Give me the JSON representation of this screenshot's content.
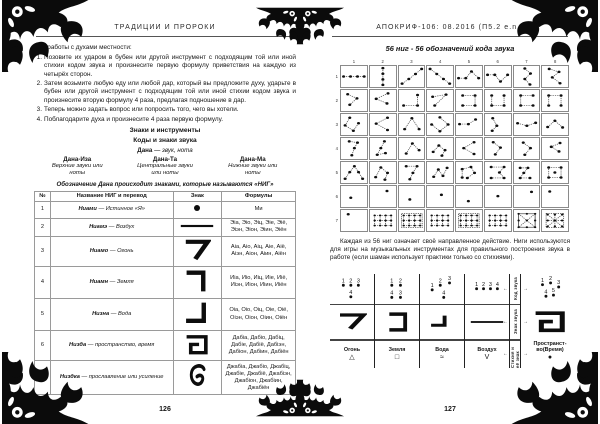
{
  "colors": {
    "ink": "#161616",
    "ornament": "#0b0b0b",
    "grid_border": "#8a8a8a"
  },
  "left_page": {
    "header": "ТРАДИЦИИ И ПРОРОКИ",
    "intro": "Для работы с духами местности:",
    "list": [
      "Позовите их ударом в бубен или другой инструмент с подходящим той или иной стихии кодом звука и произнесите первую формулу приветствия на каждую из четырёх сторон.",
      "Затем возьмите любую еду или любой дар, который вы предложите духу, ударьте в бубен или другой инструмент с подходящим той или иной стихии кодом звука и произнесите вторую формулу 4 раза, предлагая подношение в дар.",
      "Теперь можно задать вопрос или попросить того, чего вы хотели.",
      "Поблагодарите духа и произнесите 4 раза первую формулу."
    ],
    "section_title": "Знаки и инструменты",
    "subsection_title": "Коды и знаки звука",
    "dana_term": "Дана",
    "dana_def": "— звук, нота",
    "dana_columns": [
      {
        "name": "Дана-Иза",
        "desc": "Верхние звуки или ноты"
      },
      {
        "name": "Дана-Та",
        "desc": "Центральные звуки или ноты"
      },
      {
        "name": "Дана-Ма",
        "desc": "Нижние звуки или ноты"
      }
    ],
    "nig_line": "Обозначение Дана происходит знаками, которые называются «НИГ»",
    "table": {
      "headers": [
        "№",
        "Название НИГ и перевод",
        "Знак",
        "Формулы"
      ],
      "rows": [
        {
          "num": "1",
          "name": "Ниами",
          "meaning": "Истинное «Я»",
          "glyph": "dot-glyph",
          "formulas": "Ми"
        },
        {
          "num": "2",
          "name": "Ниамэ",
          "meaning": "Воздух",
          "glyph": "bar-glyph",
          "formulas": "Эiа, Эiо, Эiц, Эiе, Эiё, Эiэн, Эiон, Эiин, Эiён"
        },
        {
          "num": "3",
          "name": "Ниамо",
          "meaning": "Огонь",
          "glyph": "seven-glyph",
          "formulas": "Аiа, Аiо, Аiц, Аiе, Аiё, Аiэн, Аiон, Аiин, Аiён"
        },
        {
          "num": "4",
          "name": "Ниамн",
          "meaning": "Земля",
          "glyph": "angle-right-glyph",
          "formulas": "Иiа, Иiо, Иiц, Иiе, Иiё, Иiэн, Иiон, Иiин, Иiён"
        },
        {
          "num": "5",
          "name": "Низна",
          "meaning": "Вода",
          "glyph": "angle-left-glyph",
          "formulas": "Оiа, Оiо, Оiц, Оiе, Оiё, Оiэн, Оiон, Оiин, Оiён"
        },
        {
          "num": "6",
          "name": "Низда",
          "meaning": "пространство, время",
          "glyph": "spiral-glyph",
          "formulas": "Дабiа, Дабiо, Дабiц, Дабiе, Дабiё, Дабiэн, Дабiон, Дабiин, Дабiён"
        },
        {
          "num": "7",
          "name": "Низдка",
          "meaning": "прославление или усиление",
          "glyph": "hook-glyph",
          "formulas": "Джабiа, Джабiо, Джабiц, Джабiе, Джабiё, Джабiэн, Джабiон, Джабiин, Джабiён"
        }
      ]
    },
    "page_number": "126"
  },
  "right_page": {
    "header": "АПОКРИФ-106: 08.2016 (П5.2 e.n.)",
    "figure": {
      "title": "56 ниг - 56 обозначений кода звука",
      "col_headers": [
        "1",
        "2",
        "3",
        "4",
        "5",
        "6",
        "7",
        "8"
      ],
      "row_headers": [
        "1",
        "2",
        "3",
        "4",
        "5",
        "6",
        "7"
      ],
      "cells": [
        {
          "p": [
            [
              10,
              50
            ],
            [
              37,
              50
            ],
            [
              64,
              50
            ],
            [
              90,
              50
            ]
          ]
        },
        {
          "p": [
            [
              50,
              10
            ],
            [
              50,
              37
            ],
            [
              50,
              64
            ],
            [
              50,
              90
            ]
          ]
        },
        {
          "p": [
            [
              12,
              84
            ],
            [
              38,
              62
            ],
            [
              64,
              38
            ],
            [
              88,
              14
            ]
          ]
        },
        {
          "p": [
            [
              12,
              14
            ],
            [
              38,
              38
            ],
            [
              64,
              62
            ],
            [
              88,
              84
            ]
          ]
        },
        {
          "p": [
            [
              10,
              58
            ],
            [
              38,
              58
            ],
            [
              60,
              26
            ],
            [
              88,
              58
            ]
          ]
        },
        {
          "p": [
            [
              10,
              42
            ],
            [
              38,
              42
            ],
            [
              60,
              74
            ],
            [
              88,
              42
            ]
          ]
        },
        {
          "p": [
            [
              42,
              12
            ],
            [
              64,
              36
            ],
            [
              42,
              62
            ],
            [
              62,
              88
            ]
          ]
        },
        {
          "p": [
            [
              28,
              14
            ],
            [
              66,
              28
            ],
            [
              40,
              54
            ],
            [
              70,
              82
            ]
          ]
        },
        {
          "p": [
            [
              26,
              20
            ],
            [
              62,
              40
            ],
            [
              34,
              70
            ]
          ]
        },
        {
          "p": [
            [
              70,
              16
            ],
            [
              24,
              42
            ],
            [
              66,
              64
            ]
          ]
        },
        {
          "p": [
            [
              18,
              74
            ],
            [
              72,
              74
            ],
            [
              72,
              24
            ]
          ]
        },
        {
          "p": [
            [
              22,
              32
            ],
            [
              74,
              22
            ],
            [
              30,
              74
            ]
          ]
        },
        {
          "p": [
            [
              26,
              26
            ],
            [
              74,
              26
            ],
            [
              74,
              74
            ],
            [
              26,
              74
            ]
          ]
        },
        {
          "p": [
            [
              26,
              26
            ],
            [
              26,
              74
            ],
            [
              74,
              74
            ],
            [
              74,
              26
            ]
          ]
        },
        {
          "p": [
            [
              74,
              26
            ],
            [
              26,
              26
            ],
            [
              26,
              74
            ],
            [
              74,
              74
            ]
          ]
        },
        {
          "p": [
            [
              26,
              74
            ],
            [
              26,
              26
            ],
            [
              74,
              26
            ],
            [
              74,
              74
            ]
          ]
        },
        {
          "p": [
            [
              34,
              18
            ],
            [
              16,
              54
            ],
            [
              48,
              80
            ],
            [
              68,
              44
            ]
          ]
        },
        {
          "p": [
            [
              68,
              18
            ],
            [
              24,
              46
            ],
            [
              68,
              76
            ]
          ]
        },
        {
          "p": [
            [
              22,
              72
            ],
            [
              50,
              20
            ],
            [
              78,
              72
            ]
          ]
        },
        {
          "p": [
            [
              50,
              16
            ],
            [
              82,
              50
            ],
            [
              50,
              82
            ],
            [
              18,
              50
            ]
          ]
        },
        {
          "p": [
            [
              14,
              48
            ],
            [
              48,
              48
            ],
            [
              76,
              26
            ]
          ]
        },
        {
          "p": [
            [
              30,
              20
            ],
            [
              46,
              56
            ],
            [
              28,
              80
            ]
          ]
        },
        {
          "p": [
            [
              14,
              44
            ],
            [
              50,
              56
            ],
            [
              84,
              42
            ]
          ]
        },
        {
          "p": [
            [
              22,
              62
            ],
            [
              50,
              32
            ],
            [
              80,
              64
            ]
          ]
        },
        {
          "p": [
            [
              32,
              16
            ],
            [
              64,
              22
            ],
            [
              52,
              48
            ],
            [
              42,
              82
            ]
          ]
        },
        {
          "p": [
            [
              56,
              16
            ],
            [
              42,
              48
            ],
            [
              28,
              80
            ],
            [
              60,
              72
            ]
          ]
        },
        {
          "p": [
            [
              28,
              74
            ],
            [
              52,
              26
            ],
            [
              78,
              58
            ]
          ]
        },
        {
          "p": [
            [
              24,
              66
            ],
            [
              46,
              36
            ],
            [
              70,
              58
            ],
            [
              58,
              84
            ]
          ]
        },
        {
          "p": [
            [
              70,
              20
            ],
            [
              30,
              48
            ],
            [
              70,
              76
            ]
          ]
        },
        {
          "p": [
            [
              32,
              20
            ],
            [
              60,
              46
            ],
            [
              40,
              78
            ]
          ]
        },
        {
          "p": [
            [
              36,
              22
            ],
            [
              64,
              48
            ],
            [
              42,
              80
            ]
          ]
        },
        {
          "p": [
            [
              70,
              24
            ],
            [
              36,
              42
            ],
            [
              66,
              64
            ]
          ]
        },
        {
          "p": [
            [
              16,
              80
            ],
            [
              34,
              48
            ],
            [
              52,
              20
            ],
            [
              68,
              48
            ],
            [
              84,
              80
            ]
          ]
        },
        {
          "p": [
            [
              22,
              72
            ],
            [
              42,
              26
            ],
            [
              68,
              52
            ],
            [
              58,
              84
            ]
          ]
        },
        {
          "p": [
            [
              28,
              20
            ],
            [
              70,
              20
            ],
            [
              54,
              52
            ],
            [
              42,
              82
            ]
          ]
        },
        {
          "p": [
            [
              26,
              70
            ],
            [
              44,
              36
            ],
            [
              62,
              66
            ],
            [
              78,
              28
            ]
          ]
        },
        {
          "p": [
            [
              24,
              74
            ],
            [
              24,
              34
            ],
            [
              58,
              24
            ],
            [
              72,
              52
            ],
            [
              44,
              76
            ]
          ]
        },
        {
          "p": [
            [
              24,
              24
            ],
            [
              74,
              24
            ],
            [
              56,
              50
            ],
            [
              74,
              76
            ],
            [
              24,
              76
            ]
          ]
        },
        {
          "p": [
            [
              24,
              28
            ],
            [
              54,
              28
            ],
            [
              38,
              52
            ],
            [
              24,
              76
            ],
            [
              62,
              76
            ]
          ]
        },
        {
          "p": [
            [
              26,
              26
            ],
            [
              74,
              26
            ],
            [
              74,
              74
            ],
            [
              26,
              74
            ]
          ],
          "closed": true,
          "extra": [
            [
              50,
              50
            ]
          ]
        },
        {
          "d": [
            [
              38,
              56
            ]
          ]
        },
        {
          "d": [
            [
              66,
              24
            ]
          ]
        },
        {
          "d": [
            [
              42,
              64
            ]
          ]
        },
        {
          "d": [
            [
              56,
              42
            ]
          ]
        },
        {
          "d": [
            [
              48,
              72
            ]
          ]
        },
        {
          "d": [
            [
              50,
              48
            ]
          ]
        },
        {
          "d": [
            [
              68,
              28
            ]
          ]
        },
        {
          "d": [
            [
              30,
              26
            ]
          ]
        },
        {
          "d": [
            [
              28,
              20
            ]
          ]
        },
        {
          "t": "grid"
        },
        {
          "t": "gridbox"
        },
        {
          "t": "grid"
        },
        {
          "t": "gridbox"
        },
        {
          "t": "grid"
        },
        {
          "t": "xbox"
        },
        {
          "t": "xgrid"
        }
      ]
    },
    "caption": "Каждая из 56 ниг означает своё направленное действие. Ниги используются для игры на музыкальных инструментах для правильного построения звука в работе (если шаман использует практики только со стихиями).",
    "legend": {
      "row_labels": [
        "Код звука",
        "Знак звука",
        "Стихия и её знак"
      ],
      "columns": [
        {
          "name": "Огонь",
          "symbol": "△",
          "glyph": "seven-glyph",
          "dots": [
            {
              "n": "1",
              "x": 20,
              "y": 32
            },
            {
              "n": "2",
              "x": 46,
              "y": 32
            },
            {
              "n": "3",
              "x": 72,
              "y": 32
            },
            {
              "n": "4",
              "x": 46,
              "y": 72
            }
          ]
        },
        {
          "name": "Земля",
          "symbol": "□",
          "glyph": "bracket-glyph",
          "dots": [
            {
              "n": "1",
              "x": 32,
              "y": 32
            },
            {
              "n": "2",
              "x": 62,
              "y": 32
            },
            {
              "n": "4",
              "x": 32,
              "y": 74
            },
            {
              "n": "3",
              "x": 62,
              "y": 74
            }
          ]
        },
        {
          "name": "Вода",
          "symbol": "≈",
          "glyph": "water-glyph",
          "dots": [
            {
              "n": "1",
              "x": 16,
              "y": 48
            },
            {
              "n": "2",
              "x": 44,
              "y": 32
            },
            {
              "n": "3",
              "x": 76,
              "y": 24
            },
            {
              "n": "4",
              "x": 56,
              "y": 74
            }
          ]
        },
        {
          "name": "Воздух",
          "symbol": "V",
          "glyph": "bar-glyph",
          "dots": [
            {
              "n": "1",
              "x": 14,
              "y": 44
            },
            {
              "n": "2",
              "x": 38,
              "y": 44
            },
            {
              "n": "3",
              "x": 62,
              "y": 44
            },
            {
              "n": "4",
              "x": 86,
              "y": 44
            }
          ]
        }
      ],
      "space_column": {
        "name": "Пространст-\nво(Время)",
        "symbol": "●",
        "glyph": "spiral-glyph",
        "dots": [
          {
            "n": "1",
            "x": 24,
            "y": 30
          },
          {
            "n": "2",
            "x": 52,
            "y": 24
          },
          {
            "n": "3",
            "x": 80,
            "y": 38
          },
          {
            "n": "4",
            "x": 36,
            "y": 70
          },
          {
            "n": "5",
            "x": 62,
            "y": 66
          }
        ]
      }
    },
    "page_number": "127"
  }
}
